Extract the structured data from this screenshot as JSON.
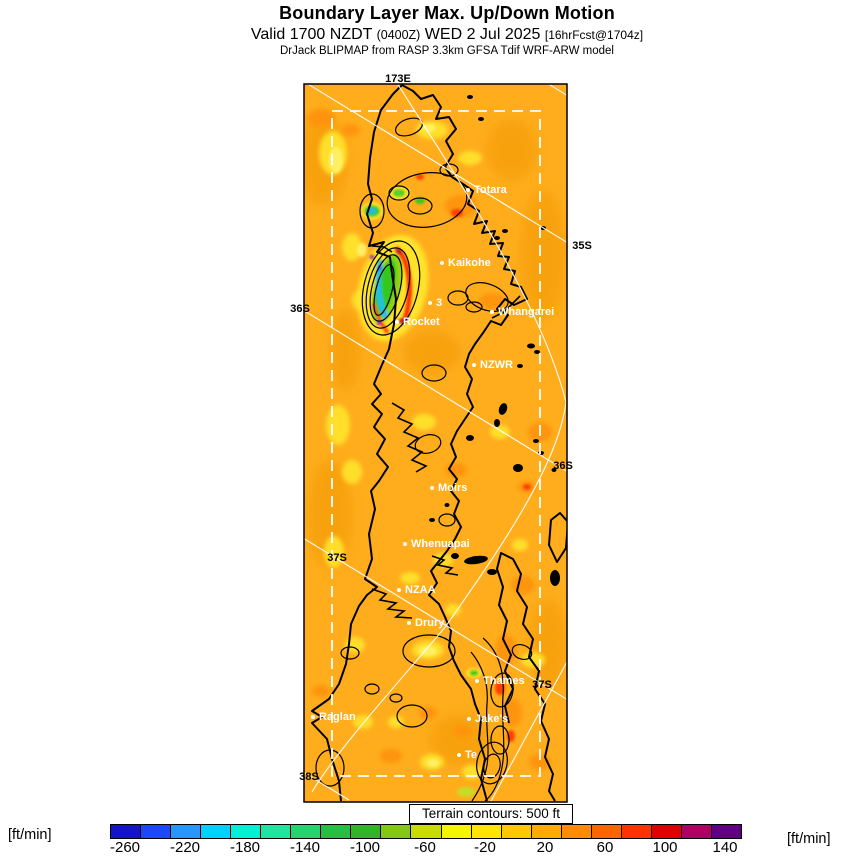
{
  "header": {
    "title": "Boundary Layer Max. Up/Down Motion",
    "valid_prefix": "Valid 1700 NZDT ",
    "valid_utc": "(0400Z)",
    "valid_date": " WED 2 Jul 2025 ",
    "valid_fcst": "[16hrFcst@1704z]",
    "model_line": "DrJack BLIPMAP from RASP 3.3km GFSA Tdif WRF-ARW model"
  },
  "map": {
    "terrain_note": "Terrain contours: 500 ft",
    "lon_label": {
      "text": "173E",
      "x": 398,
      "y": 79
    },
    "graticule_labels": [
      {
        "text": "35S",
        "x": 582,
        "y": 246
      },
      {
        "text": "36S",
        "x": 300,
        "y": 309
      },
      {
        "text": "36S",
        "x": 563,
        "y": 466
      },
      {
        "text": "37S",
        "x": 337,
        "y": 558
      },
      {
        "text": "37S",
        "x": 542,
        "y": 685
      },
      {
        "text": "38S",
        "x": 309,
        "y": 777
      }
    ],
    "sites": [
      {
        "name": "Totara",
        "x": 466,
        "y": 190
      },
      {
        "name": "Kaikohe",
        "x": 440,
        "y": 263
      },
      {
        "name": "3",
        "x": 428,
        "y": 303
      },
      {
        "name": "Rocket",
        "x": 395,
        "y": 322
      },
      {
        "name": "Whangarei",
        "x": 490,
        "y": 312
      },
      {
        "name": "NZWR",
        "x": 472,
        "y": 365
      },
      {
        "name": "Moirs",
        "x": 430,
        "y": 488
      },
      {
        "name": "Whenuapai",
        "x": 403,
        "y": 544
      },
      {
        "name": "NZAA",
        "x": 397,
        "y": 590
      },
      {
        "name": "Drury",
        "x": 407,
        "y": 623
      },
      {
        "name": "Thames",
        "x": 475,
        "y": 681
      },
      {
        "name": "Jake's",
        "x": 467,
        "y": 719
      },
      {
        "name": "Te",
        "x": 457,
        "y": 755
      },
      {
        "name": "Raglan",
        "x": 311,
        "y": 717
      }
    ]
  },
  "colorbar": {
    "unit_left": "[ft/min]",
    "unit_right": "[ft/min]",
    "min": -270,
    "max": 150,
    "ticks": [
      -260,
      -220,
      -180,
      -140,
      -100,
      -60,
      -20,
      20,
      60,
      100,
      140
    ],
    "colors": [
      "#1414cd",
      "#1e46ff",
      "#2896ff",
      "#00d2ff",
      "#00f0d2",
      "#1ee6a0",
      "#28d26e",
      "#28be46",
      "#32b428",
      "#82c814",
      "#c8dc00",
      "#f5f500",
      "#ffe600",
      "#ffc800",
      "#ffaa00",
      "#ff8c00",
      "#ff6400",
      "#ff3200",
      "#e10000",
      "#af0064",
      "#5f0082"
    ],
    "field_base_color": "#ffad1c",
    "accent_up_color": "#ff3000",
    "accent_down_color": "#1fc0f0"
  }
}
